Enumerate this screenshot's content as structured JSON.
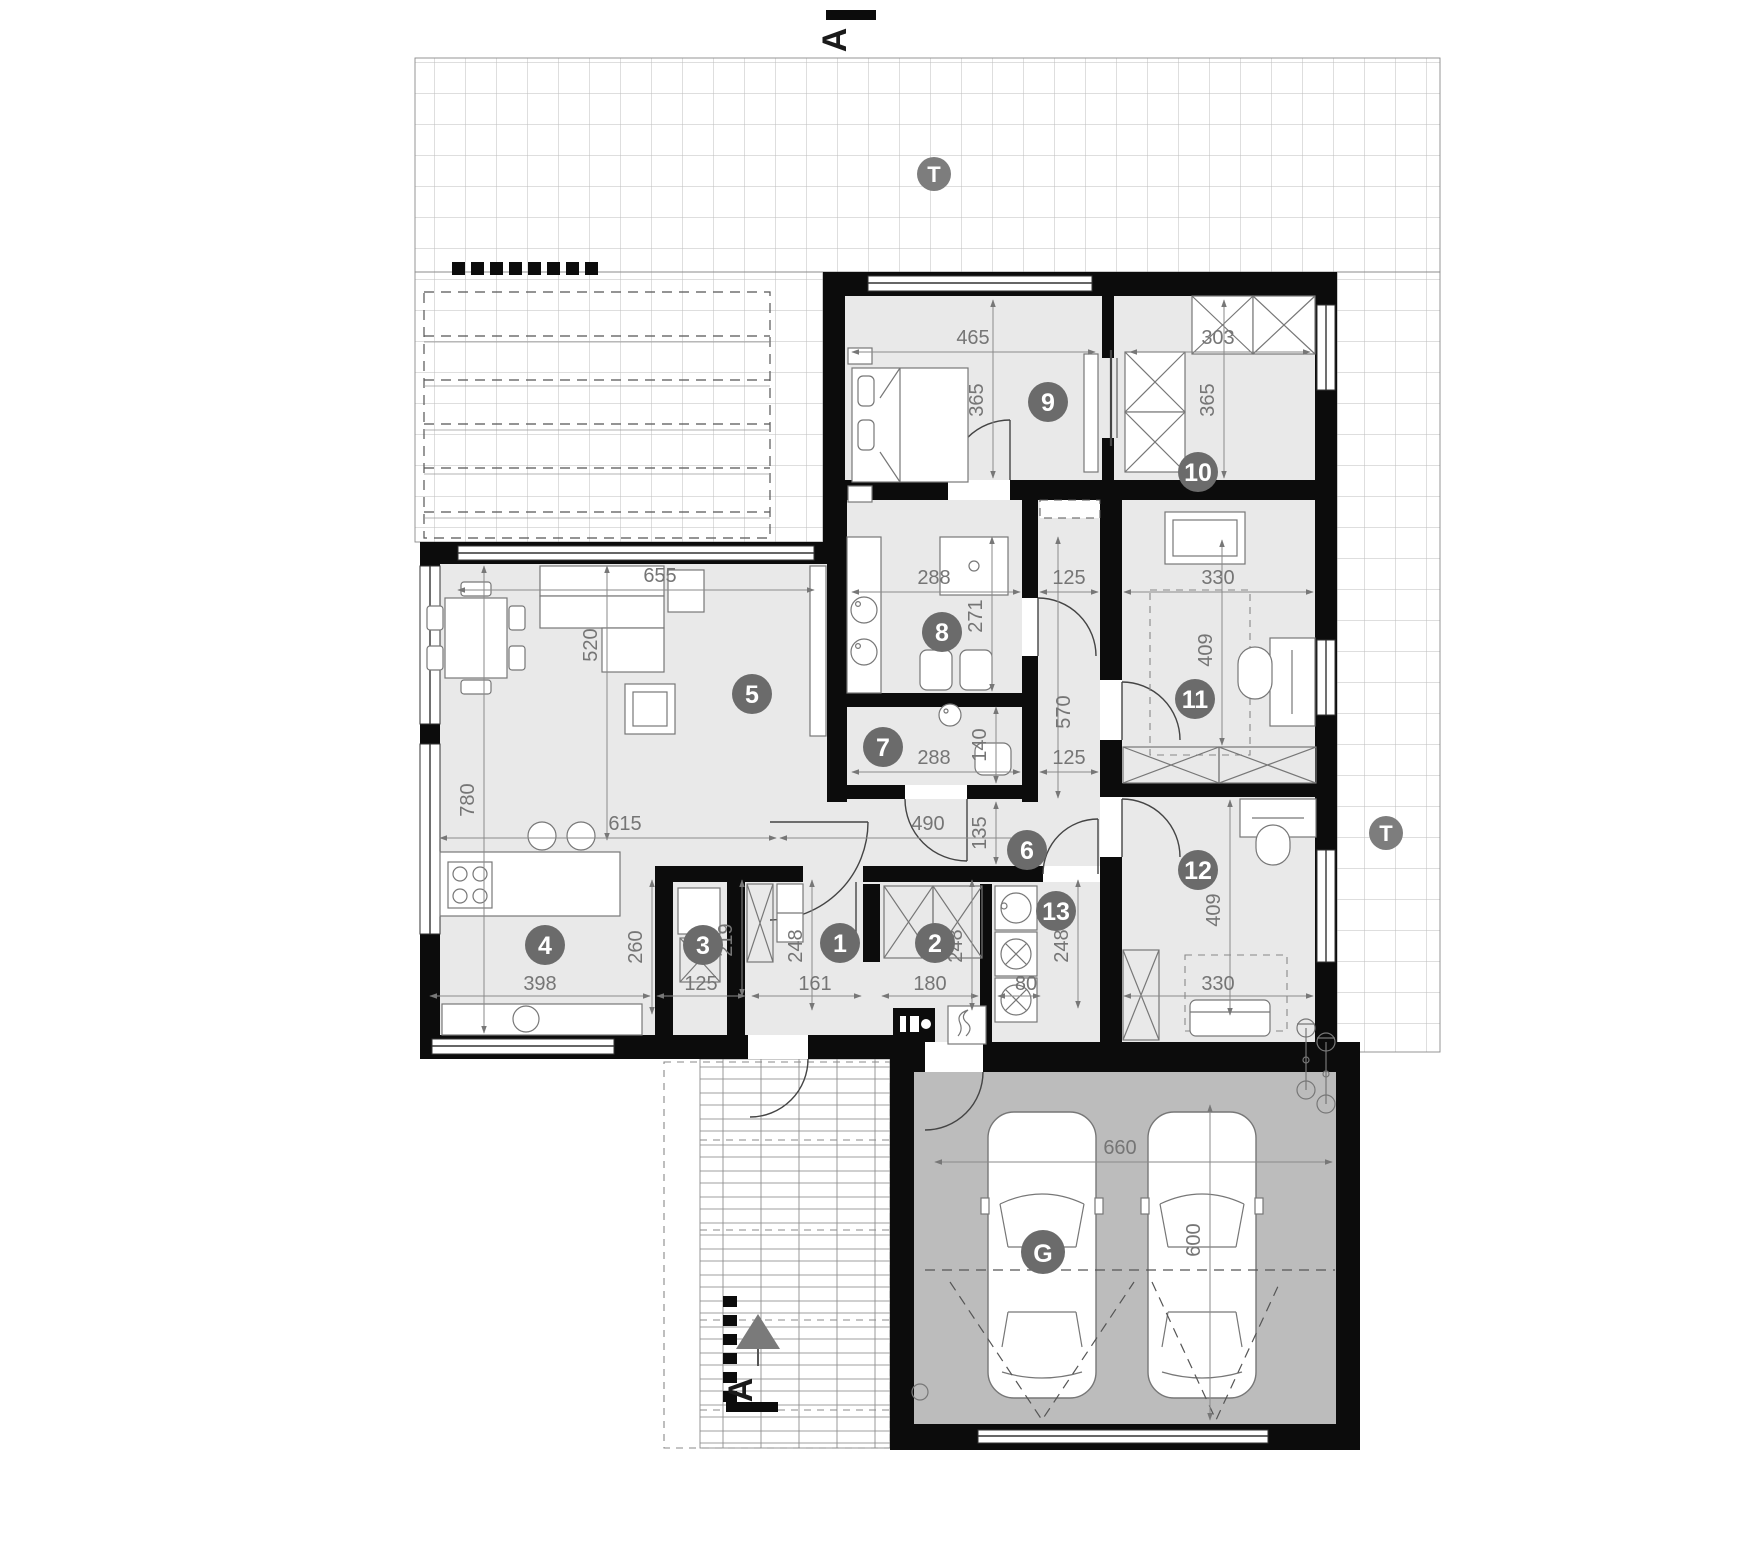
{
  "title": "Single-storey house floor plan with garage",
  "colors": {
    "wall": "#0c0c0c",
    "floor": "#e9e9e9",
    "garage_floor": "#bcbcbc",
    "label_circle": "#6b6b6b",
    "terrace_marker_circle": "#7d7d7d",
    "dim_text": "#757575"
  },
  "rooms": [
    {
      "n": "1",
      "x": 840,
      "y": 943
    },
    {
      "n": "2",
      "x": 935,
      "y": 943
    },
    {
      "n": "3",
      "x": 703,
      "y": 945
    },
    {
      "n": "4",
      "x": 545,
      "y": 945
    },
    {
      "n": "5",
      "x": 752,
      "y": 694
    },
    {
      "n": "6",
      "x": 1027,
      "y": 850
    },
    {
      "n": "7",
      "x": 883,
      "y": 747
    },
    {
      "n": "8",
      "x": 942,
      "y": 632
    },
    {
      "n": "9",
      "x": 1048,
      "y": 402
    },
    {
      "n": "10",
      "x": 1198,
      "y": 472
    },
    {
      "n": "11",
      "x": 1195,
      "y": 699
    },
    {
      "n": "12",
      "x": 1198,
      "y": 870
    },
    {
      "n": "13",
      "x": 1056,
      "y": 911
    }
  ],
  "garage_marker": {
    "n": "G",
    "x": 1043,
    "y": 1252
  },
  "terrace_markers": [
    {
      "n": "T",
      "x": 934,
      "y": 174
    },
    {
      "n": "T",
      "x": 1386,
      "y": 833
    }
  ],
  "section_markers": [
    {
      "n": "A",
      "x": 846,
      "y": 40,
      "pos": "top"
    },
    {
      "n": "A",
      "x": 752,
      "y": 1390,
      "pos": "bottom"
    }
  ],
  "dims": [
    {
      "v": "465",
      "x": 973,
      "y": 344,
      "rot": 0
    },
    {
      "v": "303",
      "x": 1218,
      "y": 344,
      "rot": 0
    },
    {
      "v": "365",
      "x": 983,
      "y": 400,
      "rot": 1
    },
    {
      "v": "365",
      "x": 1214,
      "y": 400,
      "rot": 1
    },
    {
      "v": "655",
      "x": 660,
      "y": 582,
      "rot": 0
    },
    {
      "v": "288",
      "x": 934,
      "y": 584,
      "rot": 0
    },
    {
      "v": "125",
      "x": 1069,
      "y": 584,
      "rot": 0
    },
    {
      "v": "330",
      "x": 1218,
      "y": 584,
      "rot": 0
    },
    {
      "v": "520",
      "x": 597,
      "y": 645,
      "rot": 1
    },
    {
      "v": "271",
      "x": 982,
      "y": 616,
      "rot": 1
    },
    {
      "v": "409",
      "x": 1212,
      "y": 650,
      "rot": 1
    },
    {
      "v": "570",
      "x": 1070,
      "y": 712,
      "rot": 1
    },
    {
      "v": "780",
      "x": 474,
      "y": 800,
      "rot": 1
    },
    {
      "v": "288",
      "x": 934,
      "y": 764,
      "rot": 0
    },
    {
      "v": "140",
      "x": 986,
      "y": 745,
      "rot": 1
    },
    {
      "v": "125",
      "x": 1069,
      "y": 764,
      "rot": 0
    },
    {
      "v": "135",
      "x": 986,
      "y": 833,
      "rot": 1
    },
    {
      "v": "615",
      "x": 625,
      "y": 830,
      "rot": 0
    },
    {
      "v": "490",
      "x": 928,
      "y": 830,
      "rot": 0
    },
    {
      "v": "398",
      "x": 540,
      "y": 990,
      "rot": 0
    },
    {
      "v": "260",
      "x": 642,
      "y": 947,
      "rot": 1
    },
    {
      "v": "125",
      "x": 701,
      "y": 990,
      "rot": 0
    },
    {
      "v": "219",
      "x": 732,
      "y": 940,
      "rot": 1
    },
    {
      "v": "248",
      "x": 802,
      "y": 946,
      "rot": 1
    },
    {
      "v": "161",
      "x": 815,
      "y": 990,
      "rot": 0
    },
    {
      "v": "180",
      "x": 930,
      "y": 990,
      "rot": 0
    },
    {
      "v": "248",
      "x": 962,
      "y": 946,
      "rot": 1
    },
    {
      "v": "80",
      "x": 1026,
      "y": 990,
      "rot": 0
    },
    {
      "v": "248",
      "x": 1068,
      "y": 946,
      "rot": 1
    },
    {
      "v": "330",
      "x": 1218,
      "y": 990,
      "rot": 0
    },
    {
      "v": "409",
      "x": 1220,
      "y": 910,
      "rot": 1
    },
    {
      "v": "660",
      "x": 1120,
      "y": 1154,
      "rot": 0
    },
    {
      "v": "600",
      "x": 1200,
      "y": 1240,
      "rot": 1
    }
  ]
}
